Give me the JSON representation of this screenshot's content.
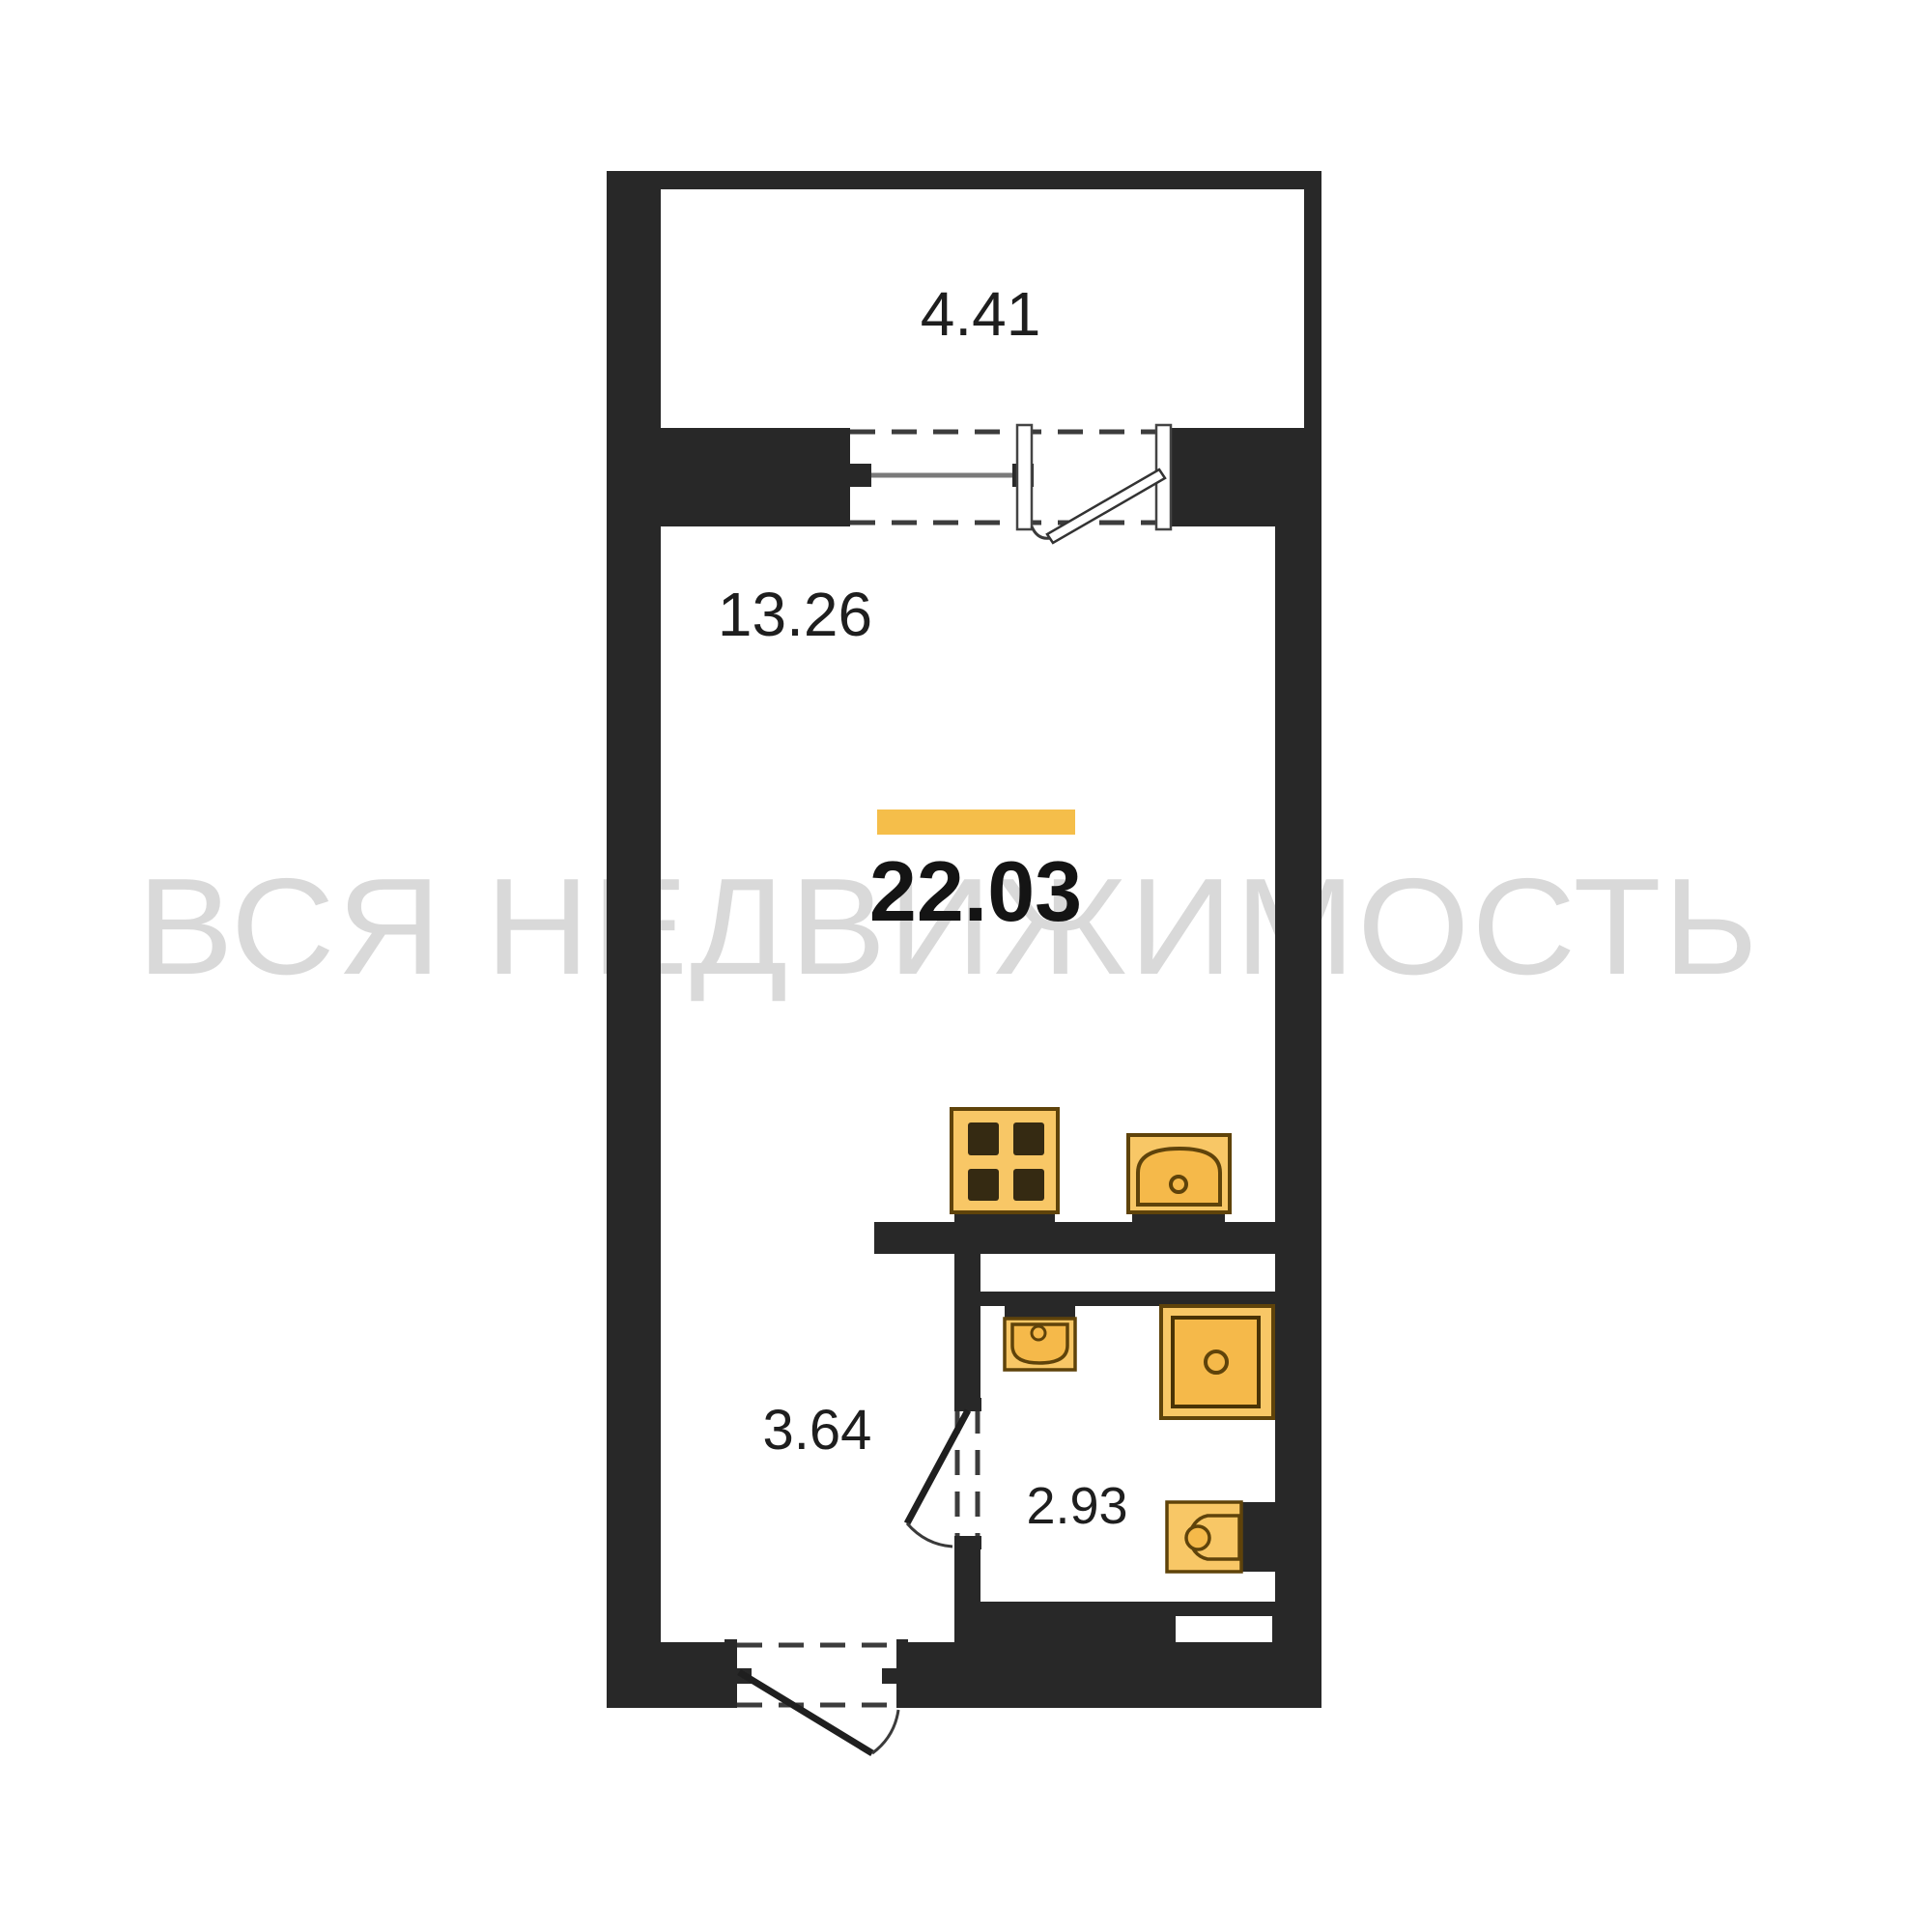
{
  "watermark": {
    "text": "ВСЯ НЕДВИЖИМОСТЬ",
    "color": "#d9d9d9"
  },
  "plan": {
    "type": "studio-apartment-floorplan",
    "total_area": {
      "value": "22.03",
      "highlight_color": "#f5be4a"
    },
    "rooms": [
      {
        "name": "balcony",
        "area": "4.41"
      },
      {
        "name": "living-room",
        "area": "13.26"
      },
      {
        "name": "hallway",
        "area": "3.64"
      },
      {
        "name": "bathroom",
        "area": "2.93"
      }
    ],
    "fixtures": [
      "stove",
      "kitchen-sink",
      "washbasin",
      "shower",
      "toilet"
    ],
    "colors": {
      "wall": "#282828",
      "floor": "#ffffff",
      "fixture_fill": "#f8c766",
      "fixture_fill_dark": "#f5b94a",
      "fixture_outline": "#5f430a",
      "highlight": "#f5be4a"
    }
  }
}
